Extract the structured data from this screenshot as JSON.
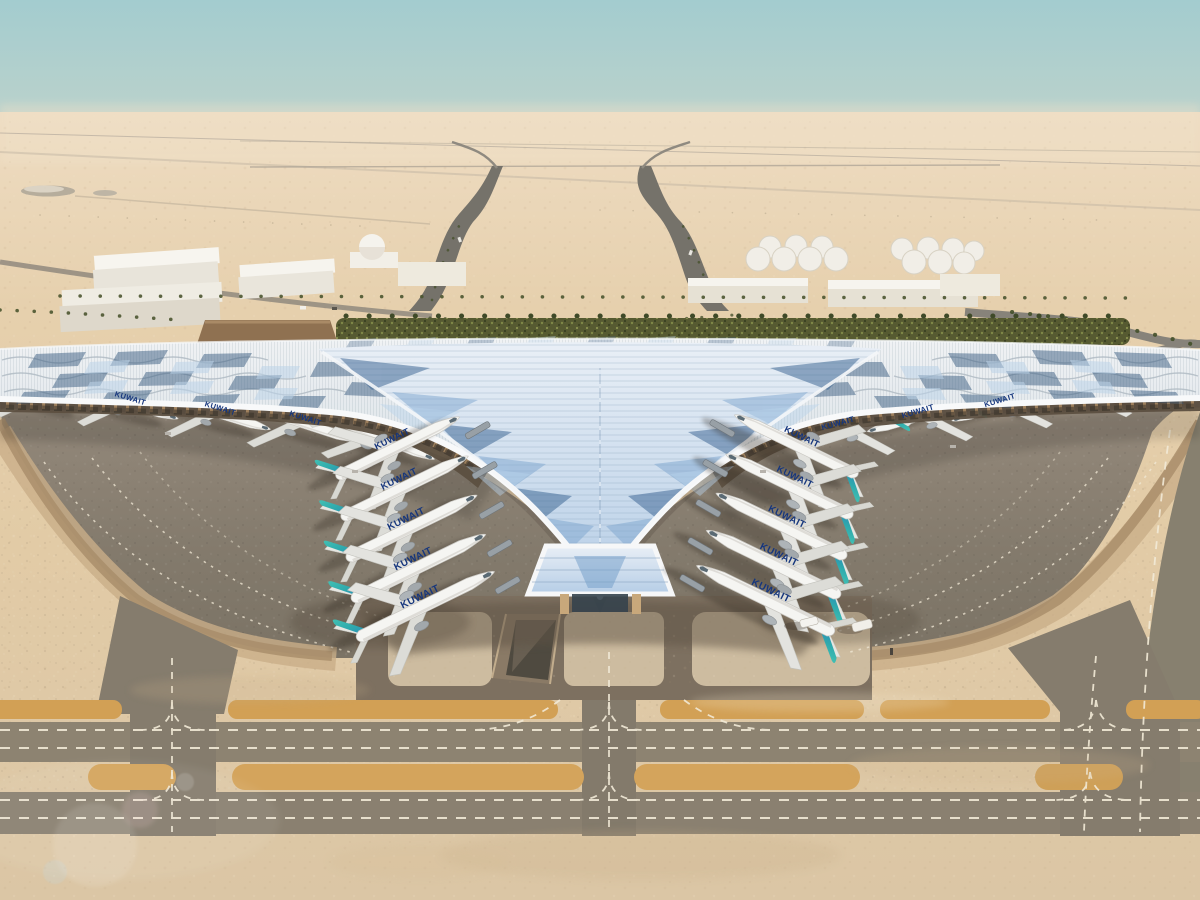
{
  "meta": {
    "title": "Aerial rendering of Kuwait International Airport new terminal",
    "type": "architectural-rendering",
    "view": "aerial"
  },
  "scene": {
    "sky": {
      "zenith": "#a3cccf",
      "haze": "#ecdcc4"
    },
    "desert": {
      "sand": "#e2cba6",
      "foreground": "#dbc6a5"
    },
    "landscape": {
      "green_strip": "#565a31",
      "palm": "#44502a"
    },
    "background_structures": [
      "cargo-warehouses",
      "dome-building",
      "fuel-tank-farm",
      "approach-roads",
      "palm-lined-boulevards"
    ],
    "terminal": {
      "roof": "#dde4e9",
      "glass_vault": "#b8cfe6",
      "edge_beam": "#f7f8f8",
      "facade_columns": "#c59f6f",
      "solar_panels": "#3d5f82",
      "wings": 3
    },
    "airside": {
      "apron": "#847a6c",
      "taxiway": "#8d8371",
      "shoulder_orange": "#d2a055",
      "marking": "#f2ead7",
      "runway_bands": 2
    },
    "aircraft": {
      "livery": "KUWAIT",
      "fuselage": "#f5f5f2",
      "tail_teal": "#45c4b4",
      "tail_blue": "#2a7fc0",
      "count": 21
    },
    "vehicles": {
      "service_vehicles": 2
    }
  }
}
